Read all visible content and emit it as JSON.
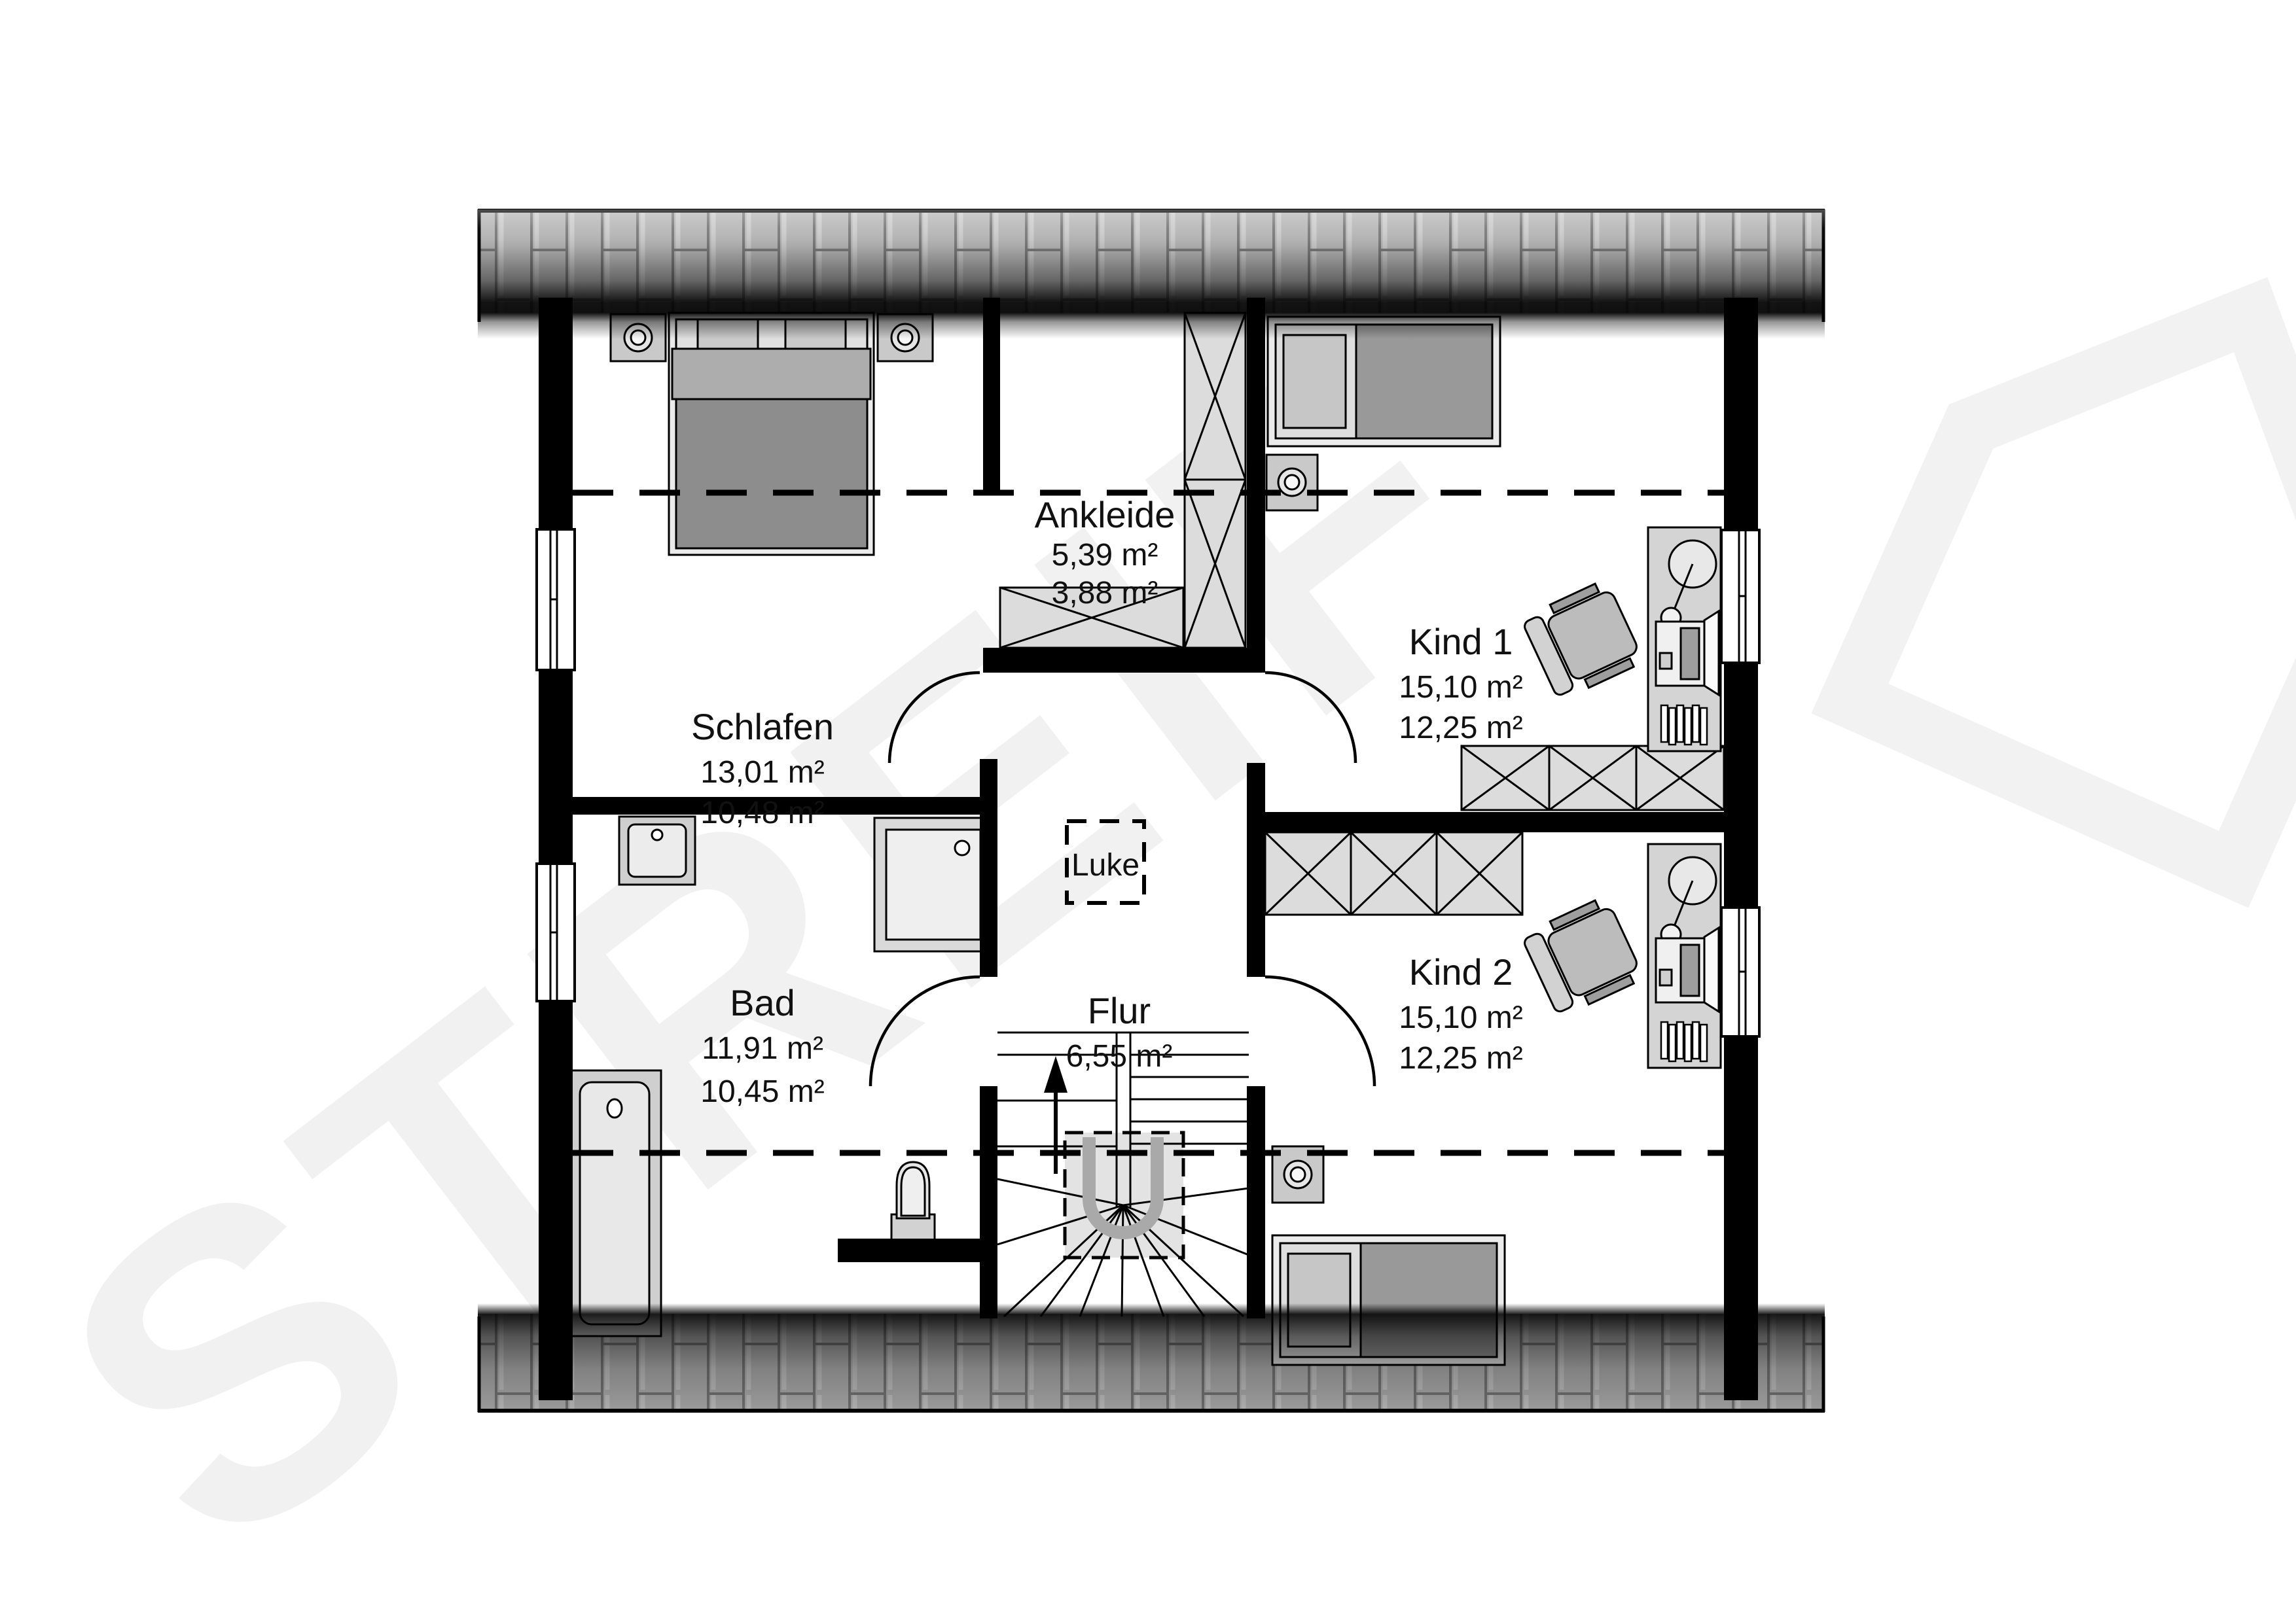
{
  "watermark": {
    "text": "STREIF",
    "color": "#f1f1f1"
  },
  "logo": {
    "name": "streif-house-logo",
    "color": "#f2f2f2"
  },
  "rooms": {
    "schlafen": {
      "name": "Schlafen",
      "area_floor": "13,01 m²",
      "area_living": "10,48 m²"
    },
    "ankleide": {
      "name": "Ankleide",
      "area_floor": "5,39 m²",
      "area_living": "3,88 m²"
    },
    "kind1": {
      "name": "Kind 1",
      "area_floor": "15,10 m²",
      "area_living": "12,25 m²"
    },
    "kind2": {
      "name": "Kind 2",
      "area_floor": "15,10 m²",
      "area_living": "12,25 m²"
    },
    "bad": {
      "name": "Bad",
      "area_floor": "11,91 m²",
      "area_living": "10,45 m²"
    },
    "flur": {
      "name": "Flur",
      "area_floor": "6,55 m²"
    }
  },
  "labels": {
    "luke": "Luke"
  },
  "colors": {
    "wall": "#000000",
    "tile_base": "#b8b8b8",
    "furniture_light": "#ebebeb",
    "furniture_mid": "#c9c9c9",
    "blanket_dark": "#8d8d8d",
    "watermark": "#f1f1f1",
    "dashed_line": "#000000"
  }
}
